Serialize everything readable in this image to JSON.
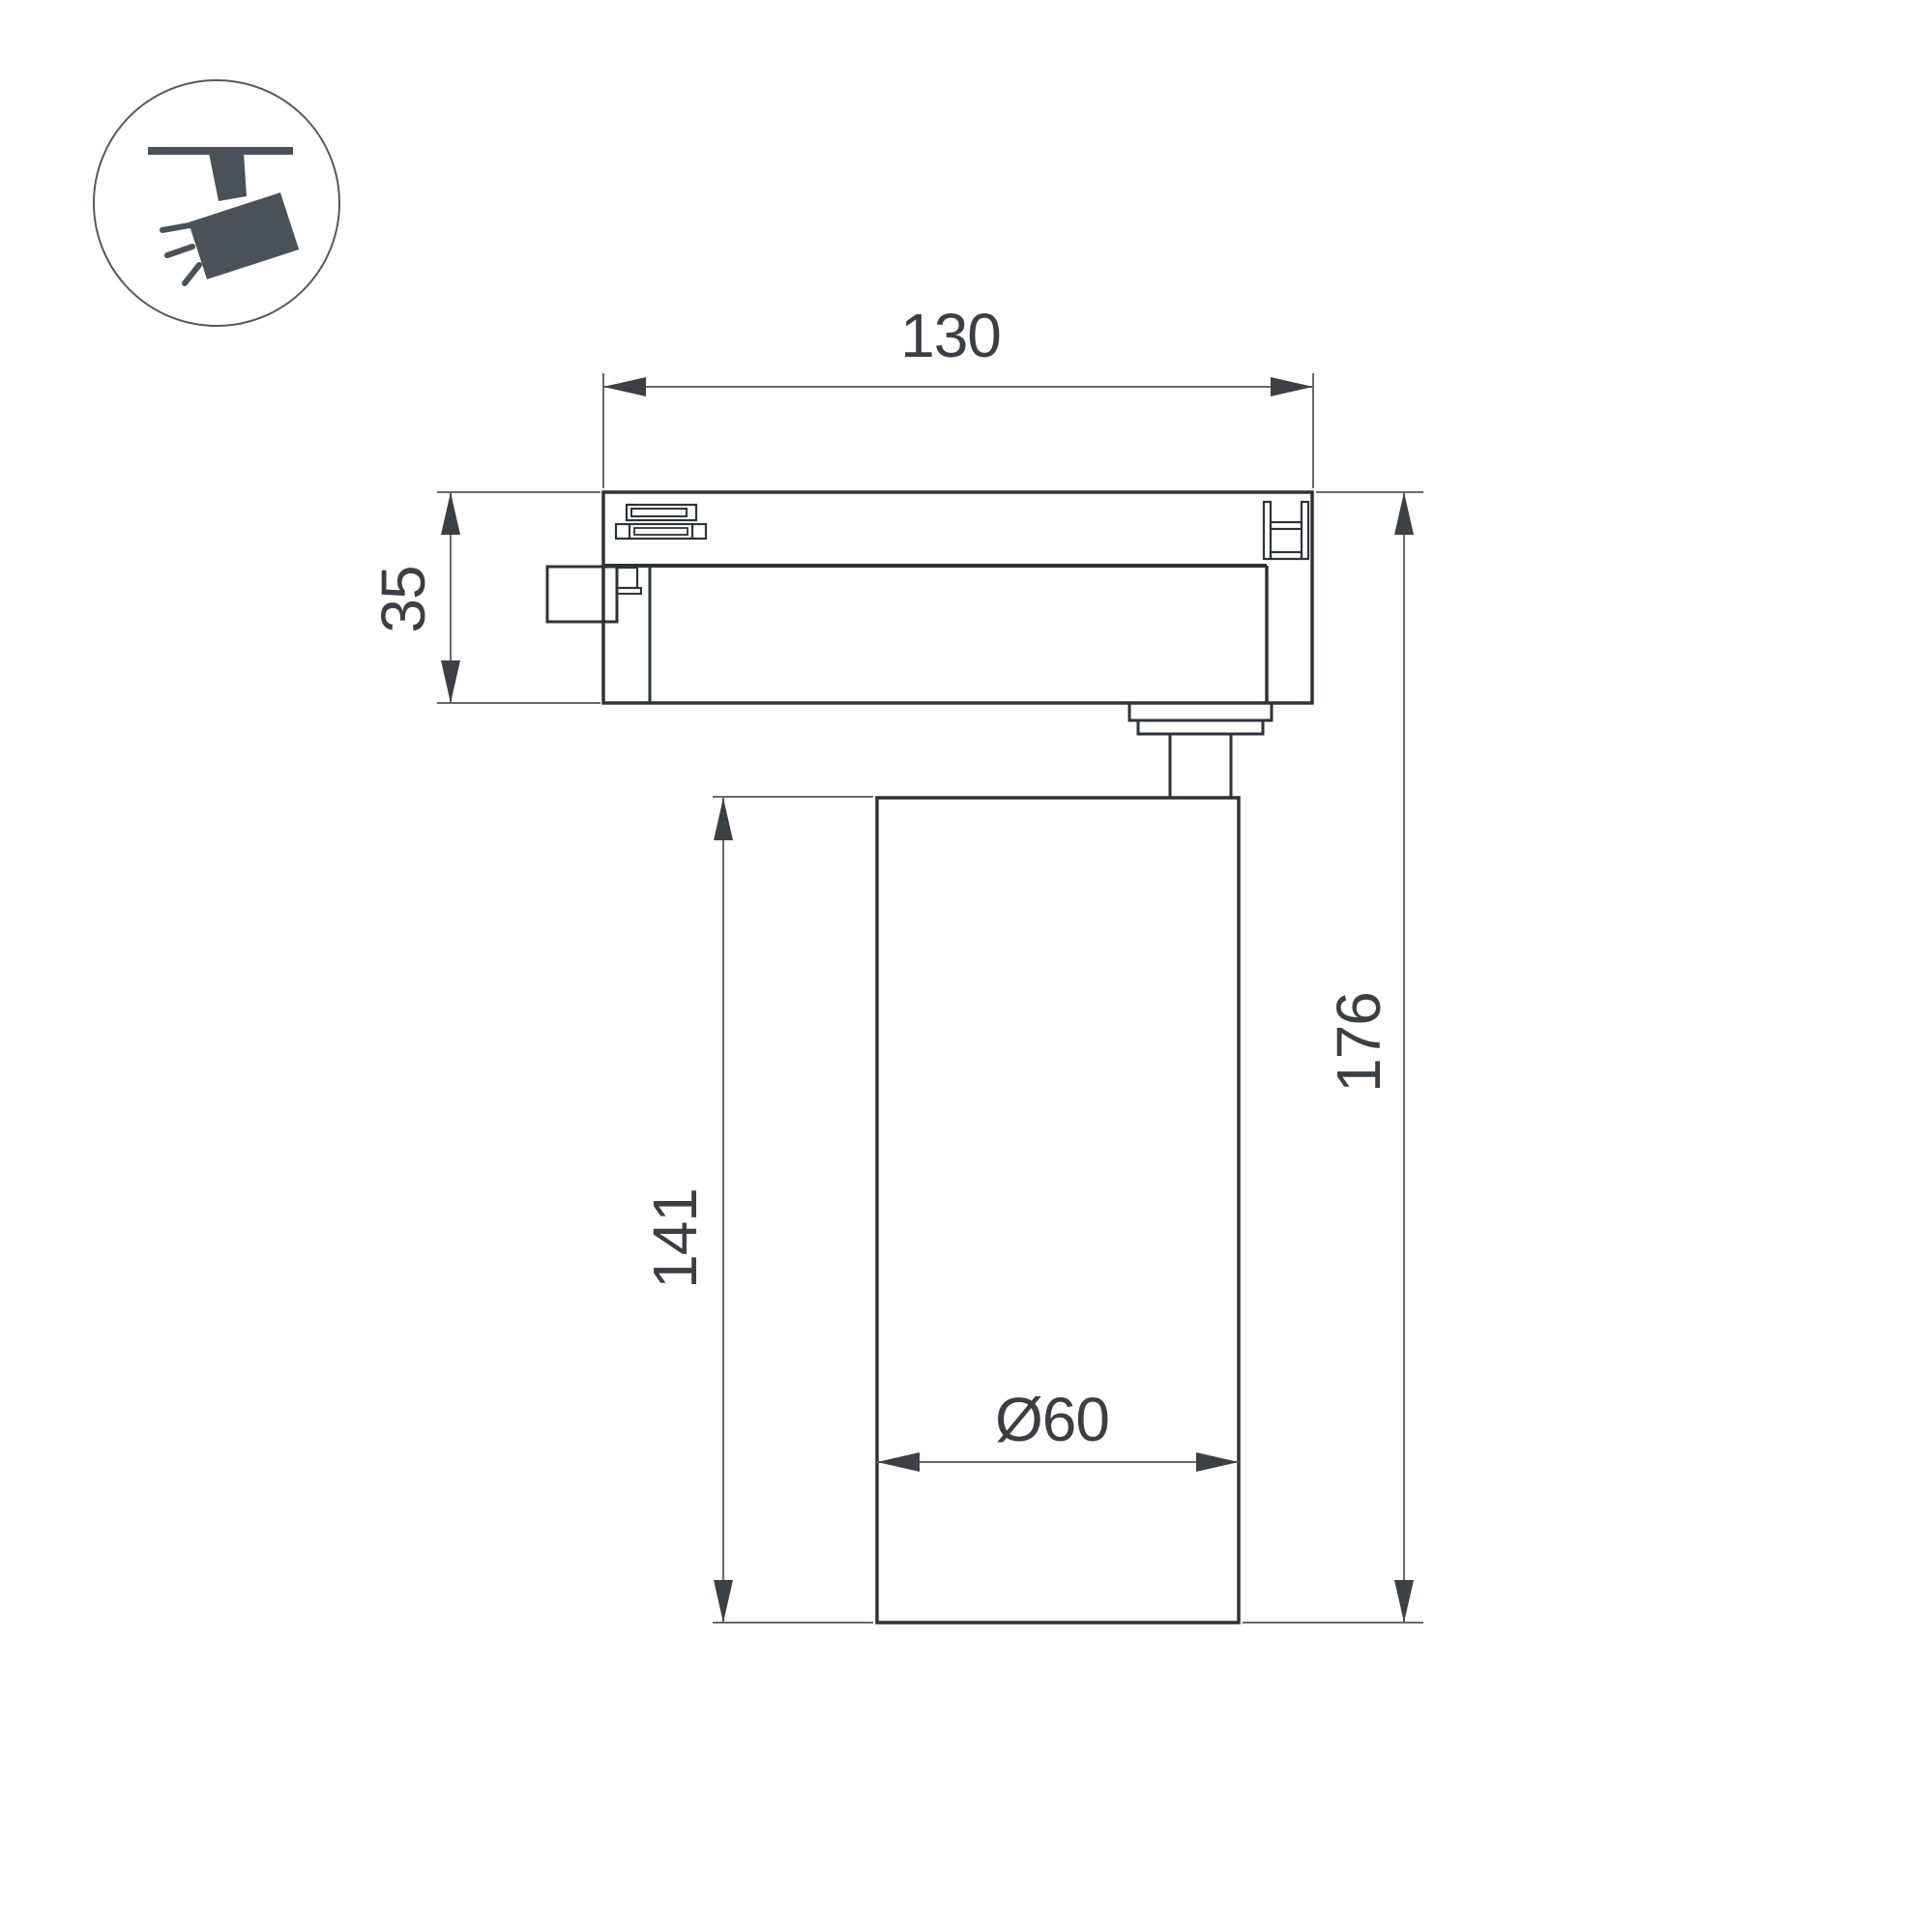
{
  "drawing": {
    "type": "technical-dimension-drawing",
    "subject": "track-mounted spotlight, side view",
    "dims": {
      "width": {
        "label": "130"
      },
      "adapter_height": {
        "label": "35"
      },
      "body_height": {
        "label": "141"
      },
      "total_height": {
        "label": "176"
      },
      "diameter": {
        "label": "Ø60"
      }
    }
  },
  "icon": {
    "name": "track-spotlight-icon",
    "color": "#4a5159",
    "circle_stroke": "#55595e"
  },
  "colors": {
    "background": "#ffffff",
    "outline": "#2e3338",
    "dim_line": "#66696e",
    "dim_text": "#3b3f44",
    "arrow": "#3c4045"
  }
}
